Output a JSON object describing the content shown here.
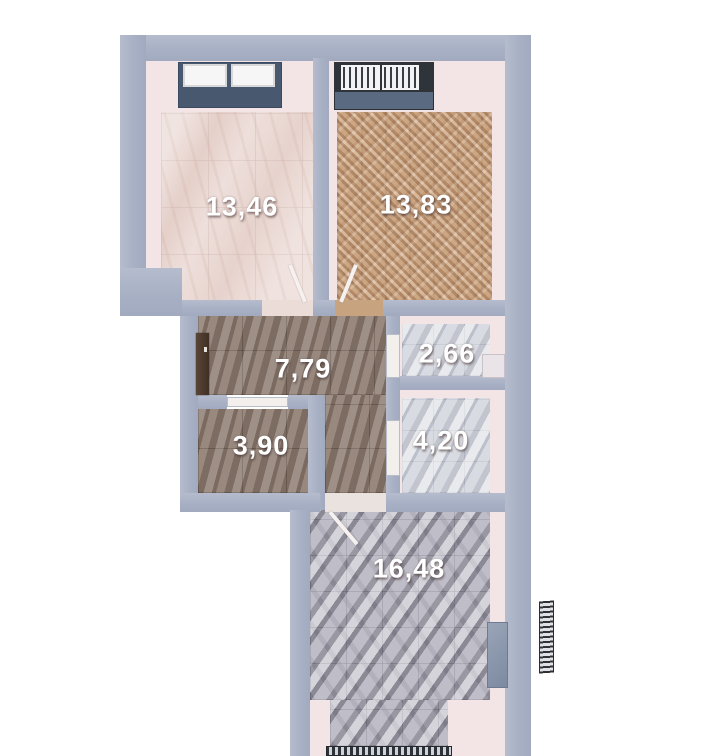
{
  "plan": {
    "title": "apartment-floor-plan",
    "colors": {
      "background": "#ffffff",
      "wall": "#a8b0c5",
      "inner_wall_face": "#f3e4e5",
      "label": "#ffffff",
      "window_glass": "#56667e",
      "window_frame_dark": "#2f343b",
      "entrance_door": "#4c3a2e",
      "floor_pink_marble": "#ead8d4",
      "floor_herringbone_wood": "#c39a76",
      "floor_dark_marble": "#8b7b70",
      "floor_light_marble": "#cdd0d8",
      "floor_gray_marble": "#b3b1bb"
    },
    "rooms": [
      {
        "id": "room-13-46",
        "area_label": "13,46",
        "floor": "pink-marble"
      },
      {
        "id": "room-13-83",
        "area_label": "13,83",
        "floor": "herringbone-wood"
      },
      {
        "id": "room-7-79",
        "area_label": "7,79",
        "floor": "dark-marble"
      },
      {
        "id": "room-2-66",
        "area_label": "2,66",
        "floor": "light-marble"
      },
      {
        "id": "room-3-90",
        "area_label": "3,90",
        "floor": "dark-marble"
      },
      {
        "id": "room-4-20",
        "area_label": "4,20",
        "floor": "light-marble"
      },
      {
        "id": "room-16-48",
        "area_label": "16,48",
        "floor": "gray-marble"
      }
    ]
  }
}
